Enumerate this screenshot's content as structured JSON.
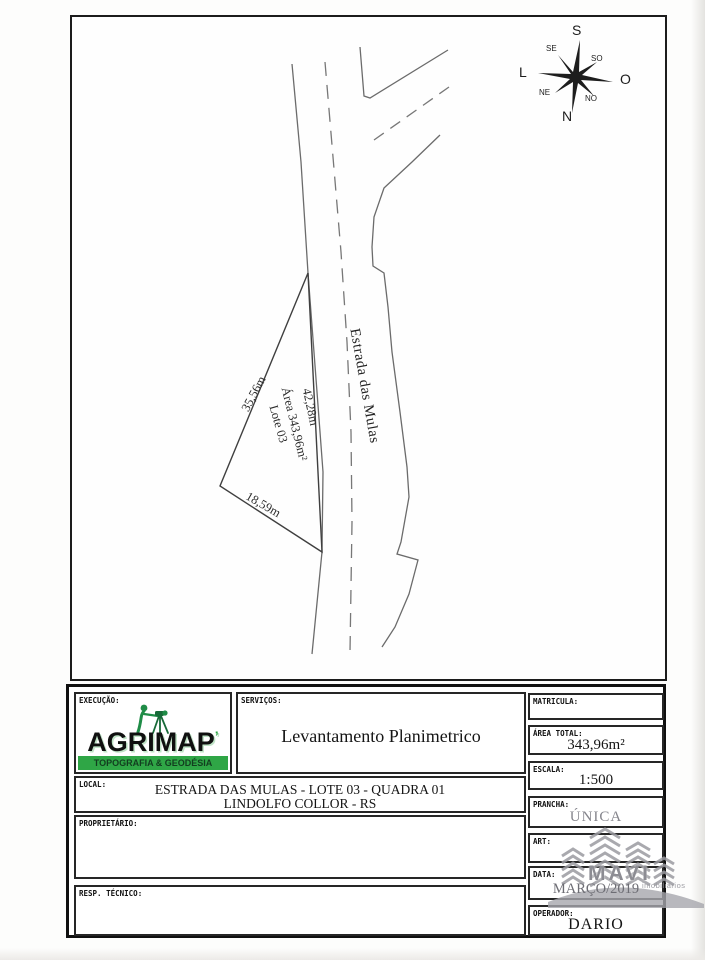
{
  "map": {
    "road_label": "Estrada das Mulas",
    "lot": {
      "edge_left": "35,56m",
      "edge_road": "42,28m",
      "edge_bottom": "18,59m",
      "area": "Área 343,96m²",
      "lot_number": "Lote 03"
    },
    "compass": {
      "s": "S",
      "n": "N",
      "l": "L",
      "o": "O",
      "se": "SE",
      "so": "SO",
      "ne": "NE",
      "no": "NO"
    }
  },
  "title_block": {
    "execucao": {
      "label": "EXECUÇÃO:"
    },
    "logo": {
      "name": "AGRIMAP",
      "mark": "’",
      "tagline": "TOPOGRAFIA & GEODÉSIA",
      "green": "#2fa646"
    },
    "servicos": {
      "label": "SERVIÇOS:",
      "value": "Levantamento Planimetrico"
    },
    "local": {
      "label": "LOCAL:",
      "line1": "ESTRADA DAS MULAS - LOTE 03 - QUADRA 01",
      "line2": "LINDOLFO COLLOR - RS"
    },
    "proprietario": {
      "label": "PROPRIETÁRIO:",
      "value": ""
    },
    "resp_tecnico": {
      "label": "RESP. TÉCNICO:",
      "value": ""
    },
    "matricula": {
      "label": "MATRICULA:",
      "value": ""
    },
    "area_total": {
      "label": "ÁREA TOTAL:",
      "value": "343,96m²"
    },
    "escala": {
      "label": "ESCALA:",
      "value": "1:500"
    },
    "prancha": {
      "label": "PRANCHA:",
      "value": "ÚNICA"
    },
    "art": {
      "label": "ART:",
      "value": ""
    },
    "data": {
      "label": "DATA:",
      "value": "MARÇO/2019"
    },
    "operador": {
      "label": "OPERADOR:",
      "value": "DARIO"
    }
  },
  "watermark": {
    "name": "MAVI",
    "subtitle": "imobiliários"
  }
}
